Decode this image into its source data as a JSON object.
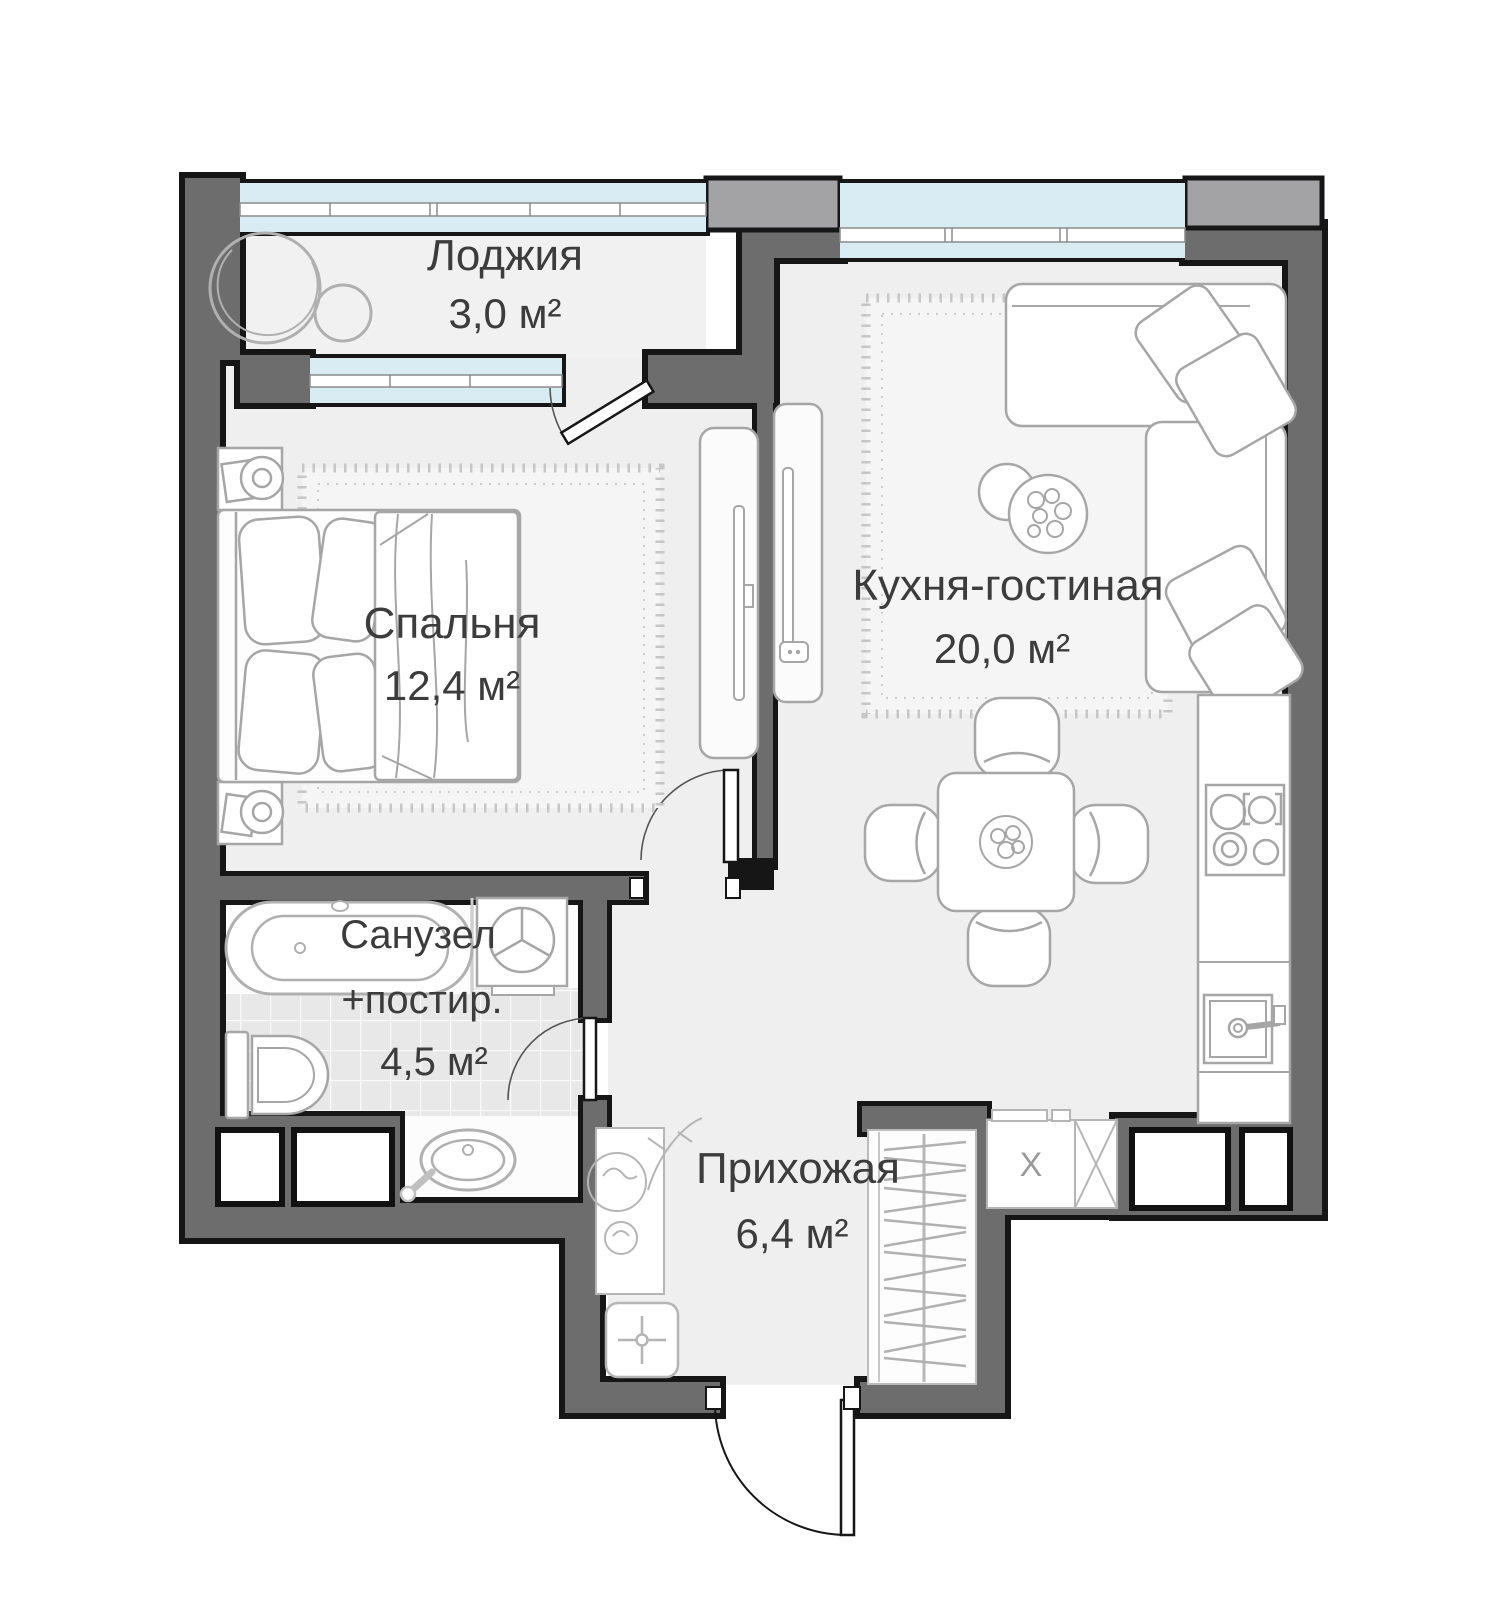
{
  "plan": {
    "rooms": {
      "loggia": {
        "name": "Лоджия",
        "area": "3,0 м²"
      },
      "bedroom": {
        "name": "Спальня",
        "area": "12,4 м²"
      },
      "kitchen_living": {
        "name": "Кухня-гостиная",
        "area": "20,0 м²"
      },
      "bathroom": {
        "name_line1": "Санузел",
        "name_line2": "+постир.",
        "area": "4,5 м²"
      },
      "hallway": {
        "name": "Прихожая",
        "area": "6,4 м²"
      }
    },
    "marks": {
      "closet": "X"
    },
    "colors": {
      "wall": "#6d6d6d",
      "wall_light": "#a3a3a5",
      "outline": "#161616",
      "glass": "#d9ecf3",
      "floor": "#efefef",
      "carpet": "#f5f5f5",
      "tile": "#e8e8e8",
      "furniture_stroke": "#a6a6a6",
      "text": "#3c3c3c"
    }
  }
}
